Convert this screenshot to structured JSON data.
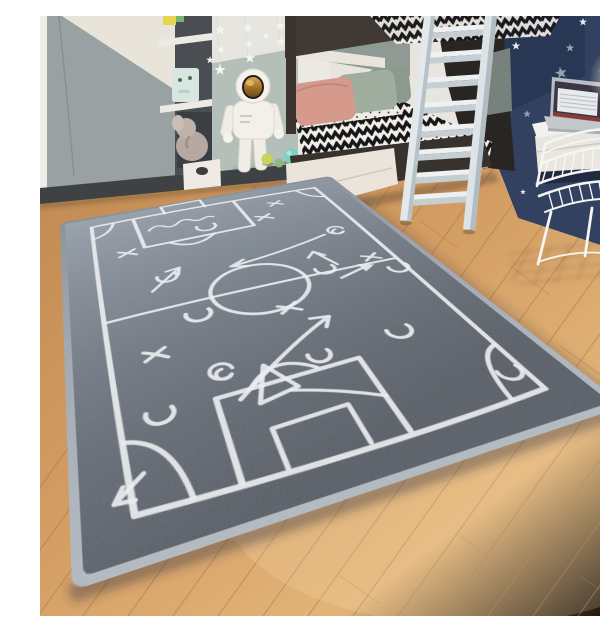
{
  "meta": {
    "type": "photograph",
    "alt_text": "Gray children's rug printed with a white chalk-style football tactics plan, lying diagonally on a light oak floor in a kids bedroom with a bunk bed, white ladder, astronaut toy, wall desk with laptop and a white wire chair",
    "caption": "Soccer tactics kids rug in grey"
  },
  "palette": {
    "rug_gray_far": "#8d97a2",
    "rug_gray_near": "#4a5059",
    "rug_binding": "#9ba3ad",
    "chalk_white": "#eaedef",
    "floor_oak_light": "#e7c18c",
    "floor_oak_dark": "#c08c54",
    "wall_navy": "#31415f",
    "wall_sage": "#b3bfb8",
    "wall_white": "#ece9e4",
    "wardrobe_gray": "#9aa1a3",
    "bed_wood_dark": "#3a332e",
    "ladder_white": "#e6eaec",
    "pillow_pink": "#d59a8c",
    "pillow_sage": "#9fae9f",
    "astronaut_white": "#f3f0ea",
    "visor_gold": "#b5832f",
    "ball_teal": "#7fcfc4",
    "ball_lime": "#c9d45a",
    "lamp_glow": "#fff7e4",
    "script_gold": "#c59a54"
  },
  "scene": {
    "objects": [
      {
        "name": "tactics-rug",
        "desc": "gray rug with white chalk soccer field, X and O marks, arrows"
      },
      {
        "name": "bunk-bed",
        "desc": "dark wood bunk bed, chevron bedding, pink and sage pillows, white drawer"
      },
      {
        "name": "ladder",
        "desc": "white bunk ladder, 8 rungs"
      },
      {
        "name": "wardrobe",
        "desc": "gray and cream diagonal-front wardrobe"
      },
      {
        "name": "shelf-unit",
        "desc": "dark shelf column with white shelves, mint box, plush elephant"
      },
      {
        "name": "astronaut-toy",
        "desc": "white astronaut figure with gold visor"
      },
      {
        "name": "star-garland",
        "desc": "white paper stars on strings"
      },
      {
        "name": "navy-star-wall",
        "desc": "dark blue wall with scattered stars"
      },
      {
        "name": "desk",
        "desc": "white wall desk with open laptop"
      },
      {
        "name": "wire-chair",
        "desc": "white metal wire chair"
      },
      {
        "name": "star-lamp",
        "desc": "glowing star night light"
      },
      {
        "name": "balls",
        "desc": "lime, green and teal toy balls on floor"
      }
    ],
    "rug_symbols": {
      "x_marks": 6,
      "o_marks": 9,
      "arrows": 7,
      "penalty_boxes": 2,
      "goals": 2,
      "center_circle": 1,
      "corner_arcs": 4
    }
  }
}
